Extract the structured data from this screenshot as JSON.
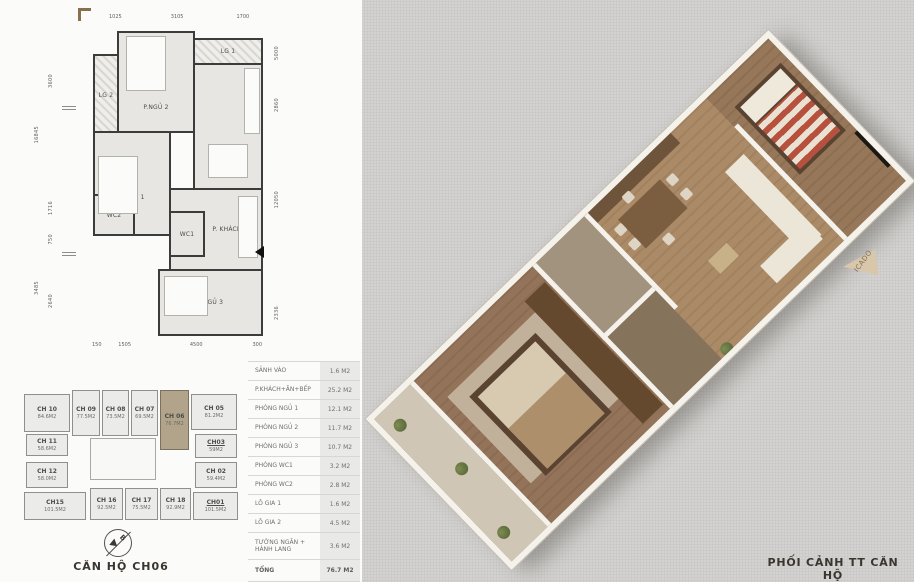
{
  "floor_plan": {
    "rooms": {
      "lg2": "LG 2",
      "pngu2": "P.NGỦ 2",
      "lg1": "LG 1",
      "bep_an": "BẾP+ĂN",
      "pngu1": "P.NGỦ 1",
      "wc2": "WC2",
      "wc1": "WC1",
      "pkhach": "P. KHÁCH",
      "pngu3": "P.NGỦ 3"
    },
    "dims": {
      "top": [
        "1025",
        "3105",
        "1700"
      ],
      "bottom": [
        "150",
        "1505",
        "4500",
        "300"
      ],
      "left_outer": [
        "16845",
        "3485"
      ],
      "left_inner": [
        "3600",
        "1716",
        "750",
        "2640"
      ],
      "right": [
        "5000",
        "2860",
        "12050",
        "2336"
      ]
    }
  },
  "key_plan": {
    "caption": "CĂN HỘ CH06",
    "compass_letter": "B",
    "units": [
      {
        "name": "CH 10",
        "area": "84.6M2",
        "highlighted": false
      },
      {
        "name": "CH 09",
        "area": "77.5M2",
        "highlighted": false
      },
      {
        "name": "CH 08",
        "area": "73.5M2",
        "highlighted": false
      },
      {
        "name": "CH 07",
        "area": "69.5M2",
        "highlighted": false
      },
      {
        "name": "CH 06",
        "area": "76.7M2",
        "highlighted": true
      },
      {
        "name": "CH 05",
        "area": "81.2M2",
        "highlighted": false
      },
      {
        "name": "CH 11",
        "area": "58.6M2",
        "highlighted": false
      },
      {
        "name": "CH03",
        "area": "59M2",
        "highlighted": false
      },
      {
        "name": "CH 12",
        "area": "58.0M2",
        "highlighted": false
      },
      {
        "name": "CH 02",
        "area": "59.4M2",
        "highlighted": false
      },
      {
        "name": "CH15",
        "area": "101.5M2",
        "highlighted": false
      },
      {
        "name": "CH 16",
        "area": "92.5M2",
        "highlighted": false
      },
      {
        "name": "CH 17",
        "area": "75.5M2",
        "highlighted": false
      },
      {
        "name": "CH 18",
        "area": "92.9M2",
        "highlighted": false
      },
      {
        "name": "CH01",
        "area": "101.5M2",
        "highlighted": false
      }
    ]
  },
  "area_table": {
    "rows": [
      {
        "label": "SẢNH VÀO",
        "value": "1.6 M2"
      },
      {
        "label": "P.KHÁCH+ĂN+BẾP",
        "value": "25.2 M2"
      },
      {
        "label": "PHÒNG NGỦ 1",
        "value": "12.1 M2"
      },
      {
        "label": "PHÒNG NGỦ 2",
        "value": "11.7 M2"
      },
      {
        "label": "PHÒNG NGỦ 3",
        "value": "10.7 M2"
      },
      {
        "label": "PHÒNG WC1",
        "value": "3.2 M2"
      },
      {
        "label": "PHÒNG WC2",
        "value": "2.8 M2"
      },
      {
        "label": "LÔ GIA 1",
        "value": "1.6 M2"
      },
      {
        "label": "LÔ GIA 2",
        "value": "4.5 M2"
      },
      {
        "label": "TƯỜNG NGĂN + HÀNH LANG",
        "value": "3.6 M2"
      },
      {
        "label": "TỔNG",
        "value": "76.7 M2"
      }
    ]
  },
  "render": {
    "caption": "PHỐI CẢNH TT CĂN HỘ",
    "watermark": "ICADO"
  },
  "colors": {
    "highlight_unit": "#b2a48b",
    "table_value_bg": "#e9e9e7",
    "page_background": "#d3d2d0",
    "wall": "#3c3c3c",
    "render_wall": "#f5f2ec"
  }
}
